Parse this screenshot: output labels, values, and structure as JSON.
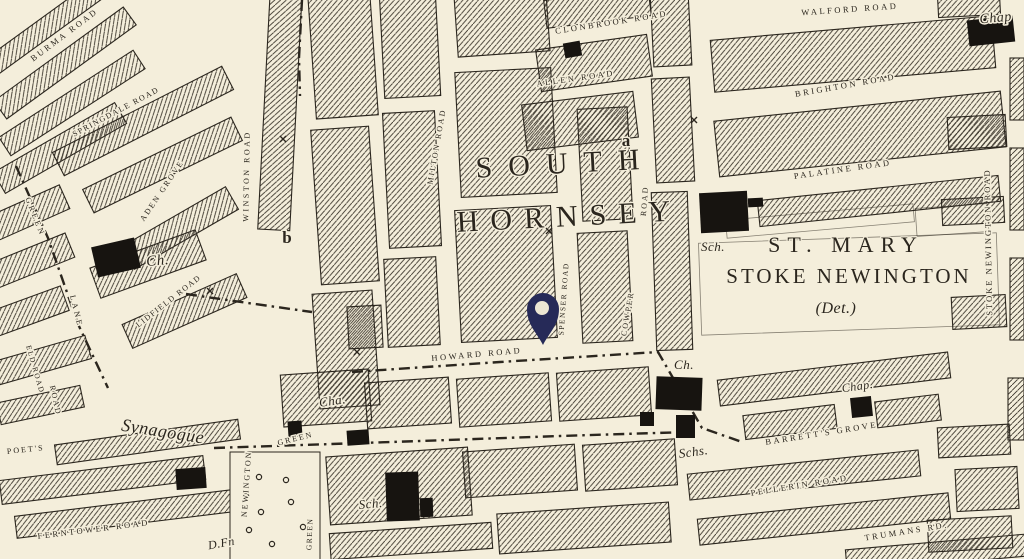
{
  "map": {
    "type": "historic-ordnance-survey-street-map",
    "area_names": [
      "SOUTH HORNSEY",
      "ST. MARY STOKE NEWINGTON"
    ],
    "colors": {
      "paper": "#f4eedb",
      "ink": "#2b261e",
      "pin": "#262a58",
      "pin_hole": "#ece6d3"
    },
    "pin": {
      "x": 543,
      "y": 345
    },
    "labels": [
      {
        "t": "CLONBROOK ROAD",
        "x": 612,
        "y": 25,
        "r": -9,
        "st": "r"
      },
      {
        "t": "ALLEN ROAD",
        "x": 576,
        "y": 81,
        "r": -8,
        "st": "r"
      },
      {
        "t": "WALFORD ROAD",
        "x": 850,
        "y": 12,
        "r": -4,
        "st": "r"
      },
      {
        "t": "BRIGHTON ROAD",
        "x": 846,
        "y": 88,
        "r": -10,
        "st": "r"
      },
      {
        "t": "PALATINE ROAD",
        "x": 843,
        "y": 172,
        "r": -8,
        "st": "r"
      },
      {
        "t": "HOWARD ROAD",
        "x": 477,
        "y": 357,
        "r": -5,
        "st": "r"
      },
      {
        "t": "SPENSER ROAD",
        "x": 566,
        "y": 299,
        "r": -86,
        "st": "r",
        "s": 7.5,
        "sp": 1.5
      },
      {
        "t": "COWPER",
        "x": 630,
        "y": 314,
        "r": -80,
        "st": "r",
        "s": 8,
        "sp": 2
      },
      {
        "t": "ROAD",
        "x": 647,
        "y": 201,
        "r": -86,
        "st": "r",
        "s": 8,
        "sp": 2
      },
      {
        "t": "MILTON ROAD",
        "x": 439,
        "y": 147,
        "r": -80,
        "st": "r",
        "s": 8,
        "sp": 2
      },
      {
        "t": "WINSTON ROAD",
        "x": 249,
        "y": 176,
        "r": -89,
        "st": "r",
        "s": 8,
        "sp": 2.5
      },
      {
        "t": "STOKE NEWINGTON ROAD",
        "x": 991,
        "y": 242,
        "r": -91,
        "st": "r",
        "s": 8.5,
        "sp": 2
      },
      {
        "t": "GREEN",
        "x": 33,
        "y": 218,
        "r": 68,
        "st": "r",
        "s": 8,
        "sp": 3
      },
      {
        "t": "LANE",
        "x": 74,
        "y": 312,
        "r": 76,
        "st": "r",
        "s": 8,
        "sp": 3
      },
      {
        "t": "ELD ROAD",
        "x": 33,
        "y": 370,
        "r": 74,
        "st": "r",
        "s": 7.5,
        "sp": 1.5
      },
      {
        "t": "BURMA ROAD",
        "x": 66,
        "y": 37,
        "r": -37,
        "st": "r"
      },
      {
        "t": "SPRINGDALE ROAD",
        "x": 117,
        "y": 114,
        "r": -28,
        "st": "r",
        "s": 8,
        "sp": 1.5
      },
      {
        "t": "ADEN GROVE",
        "x": 164,
        "y": 192,
        "r": -56,
        "st": "r",
        "s": 8,
        "sp": 2
      },
      {
        "t": "LIDFIELD ROAD",
        "x": 170,
        "y": 303,
        "r": -38,
        "st": "r",
        "s": 8,
        "sp": 1.5
      },
      {
        "t": "FERNTOWER ROAD",
        "x": 94,
        "y": 532,
        "r": -7,
        "st": "r"
      },
      {
        "t": "POET'S",
        "x": 26,
        "y": 452,
        "r": -6,
        "st": "r",
        "s": 8,
        "sp": 2
      },
      {
        "t": "ROAD",
        "x": 53,
        "y": 401,
        "r": 78,
        "st": "r",
        "s": 8,
        "sp": 2
      },
      {
        "t": "NEWINGTON",
        "x": 249,
        "y": 484,
        "r": -86,
        "st": "r",
        "s": 8,
        "sp": 2
      },
      {
        "t": "GREEN",
        "x": 296,
        "y": 441,
        "r": -14,
        "st": "r",
        "s": 8,
        "sp": 2
      },
      {
        "t": "GREEN",
        "x": 312,
        "y": 534,
        "r": -88,
        "st": "r",
        "s": 7.5,
        "sp": 1.5
      },
      {
        "t": "BARRETT'S GROVE",
        "x": 822,
        "y": 436,
        "r": -9,
        "st": "r"
      },
      {
        "t": "PELLERIN ROAD",
        "x": 800,
        "y": 488,
        "r": -9,
        "st": "r"
      },
      {
        "t": "TRUMANS RD.",
        "x": 907,
        "y": 534,
        "r": -9,
        "st": "r"
      },
      {
        "t": "SOUTH",
        "x": 566,
        "y": 173,
        "r": -3,
        "st": "d",
        "s": 30,
        "sp": 16
      },
      {
        "t": "HORNSEY",
        "x": 570,
        "y": 226,
        "r": -3,
        "st": "d",
        "s": 30,
        "sp": 12
      },
      {
        "t": "ST. MARY",
        "x": 846,
        "y": 252,
        "r": 0,
        "st": "d",
        "s": 22,
        "sp": 7
      },
      {
        "t": "STOKE NEWINGTON",
        "x": 849,
        "y": 283,
        "r": 0,
        "st": "d",
        "s": 21,
        "sp": 3
      },
      {
        "t": "(Det.)",
        "x": 836,
        "y": 313,
        "r": 0,
        "st": "p",
        "s": 16
      },
      {
        "t": "Synagogue",
        "x": 162,
        "y": 437,
        "r": 9,
        "st": "p",
        "s": 18
      },
      {
        "t": "Ch.",
        "x": 158,
        "y": 265,
        "r": -5,
        "st": "p",
        "s": 15
      },
      {
        "t": "Ch.",
        "x": 684,
        "y": 369,
        "r": 0,
        "st": "p",
        "s": 13
      },
      {
        "t": "Sch.",
        "x": 713,
        "y": 251,
        "r": 0,
        "st": "p",
        "s": 13
      },
      {
        "t": "Sch.",
        "x": 371,
        "y": 508,
        "r": -5,
        "st": "p",
        "s": 13
      },
      {
        "t": "Schs.",
        "x": 694,
        "y": 456,
        "r": -8,
        "st": "p",
        "s": 13
      },
      {
        "t": "Cha.",
        "x": 333,
        "y": 405,
        "r": -8,
        "st": "p",
        "s": 13
      },
      {
        "t": "Chap",
        "x": 996,
        "y": 22,
        "r": -5,
        "st": "p",
        "s": 14
      },
      {
        "t": "Chap.",
        "x": 858,
        "y": 390,
        "r": -8,
        "st": "p",
        "s": 12
      },
      {
        "t": "D.Fn",
        "x": 222,
        "y": 547,
        "r": -10,
        "st": "p",
        "s": 12
      },
      {
        "t": "a",
        "x": 626,
        "y": 146,
        "r": 0,
        "st": "m",
        "s": 17
      },
      {
        "t": "b",
        "x": 287,
        "y": 243,
        "r": 0,
        "st": "m",
        "s": 17
      }
    ]
  }
}
